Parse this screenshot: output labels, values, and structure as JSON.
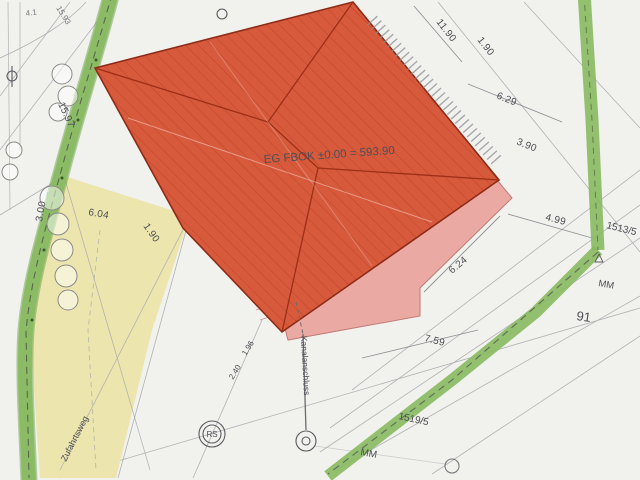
{
  "plan": {
    "building_label": "EG FBOK ±0.00 = 593.90",
    "utility_label": "Kanalanschluss",
    "driveway_label": "Zufahrtsweg",
    "parcel_numbers": {
      "right": "1513/5",
      "center": "91",
      "bottom": "1519/5"
    },
    "marker_labels": {
      "mm_right": "MM",
      "mm_bottom": "MM",
      "shaft": "RS"
    },
    "dimensions": {
      "top_right_a": "11.90",
      "top_right_b": "1.90",
      "right_a": "6.29",
      "right_b": "3.90",
      "right_c": "4.99",
      "mid_a": "6.24",
      "mid_b": "7.59",
      "left_a": "6.04",
      "left_b": "1.90",
      "left_c": "3.00",
      "left_d": "15.97",
      "small_a": "1.96",
      "small_b": "2.40",
      "corner_a": "4.1",
      "corner_b": "15.93"
    },
    "colors": {
      "paper": "#f1f1ed",
      "building": "#d85a3c",
      "building_hatch": "#a93418",
      "building_outline": "#8e2b16",
      "terrace": "#eaa9a3",
      "terrace_outline": "#c07a74",
      "hedge": "#87ba5f",
      "hedge_dark": "#5d9a3c",
      "area_yellow": "#ece5ad",
      "survey_line": "#a6a7ab",
      "dim_line": "#85868c",
      "text": "#4e4e56"
    }
  }
}
